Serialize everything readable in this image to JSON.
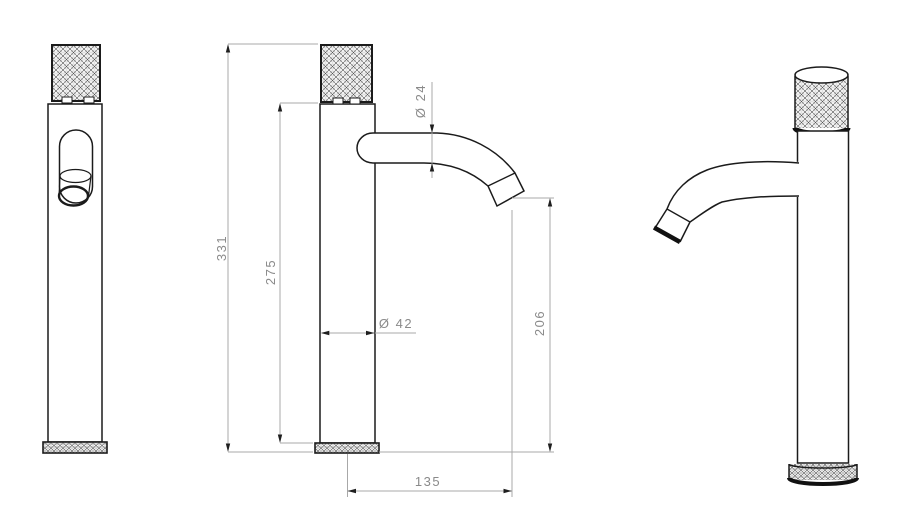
{
  "drawing": {
    "views": [
      {
        "name": "front-view"
      },
      {
        "name": "side-view-with-dimensions"
      },
      {
        "name": "perspective-view"
      }
    ]
  },
  "dims": {
    "overall_height": "331",
    "body_height": "275",
    "spout_diameter": "Ø 24",
    "body_diameter": "Ø 42",
    "outlet_height": "206",
    "spout_reach": "135"
  },
  "colors": {
    "object_line": "#1b1b1b",
    "dimension_line": "#a8a8a8",
    "dimension_text": "#8a8a8a",
    "arrow": "#1f1f1f",
    "background": "#ffffff"
  }
}
